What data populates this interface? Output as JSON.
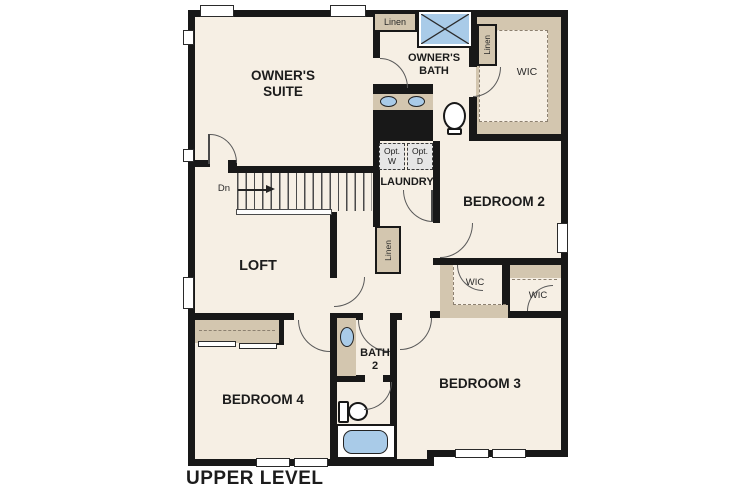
{
  "plan": {
    "title": "UPPER LEVEL"
  },
  "rooms": {
    "owners_suite": {
      "label": "OWNER'S SUITE"
    },
    "owners_bath": {
      "label": "OWNER'S BATH"
    },
    "owners_wic": {
      "label": "WIC"
    },
    "laundry": {
      "label": "LAUNDRY"
    },
    "bedroom2": {
      "label": "BEDROOM 2"
    },
    "loft": {
      "label": "LOFT"
    },
    "bedroom4": {
      "label": "BEDROOM 4"
    },
    "bath2": {
      "label": "BATH 2"
    },
    "bedroom3": {
      "label": "BEDROOM 3"
    },
    "bedroom2_wic": {
      "label": "WIC"
    },
    "bedroom3_wic": {
      "label": "WIC"
    }
  },
  "closets": {
    "linen_bath": {
      "label": "Linen"
    },
    "linen_wic": {
      "label": "Linen"
    },
    "linen_hall": {
      "label": "Linen"
    }
  },
  "laundry_options": {
    "washer": {
      "line1": "Opt.",
      "line2": "W"
    },
    "dryer": {
      "line1": "Opt.",
      "line2": "D"
    }
  },
  "stairs": {
    "direction_label": "Dn"
  },
  "colors": {
    "wall": "#181818",
    "floor": "#f6efe4",
    "shelf_tan": "#d3c6af",
    "fixture_blue": "#a9cbe8",
    "option_box_gray": "#e6e6e6",
    "background": "#ffffff"
  }
}
